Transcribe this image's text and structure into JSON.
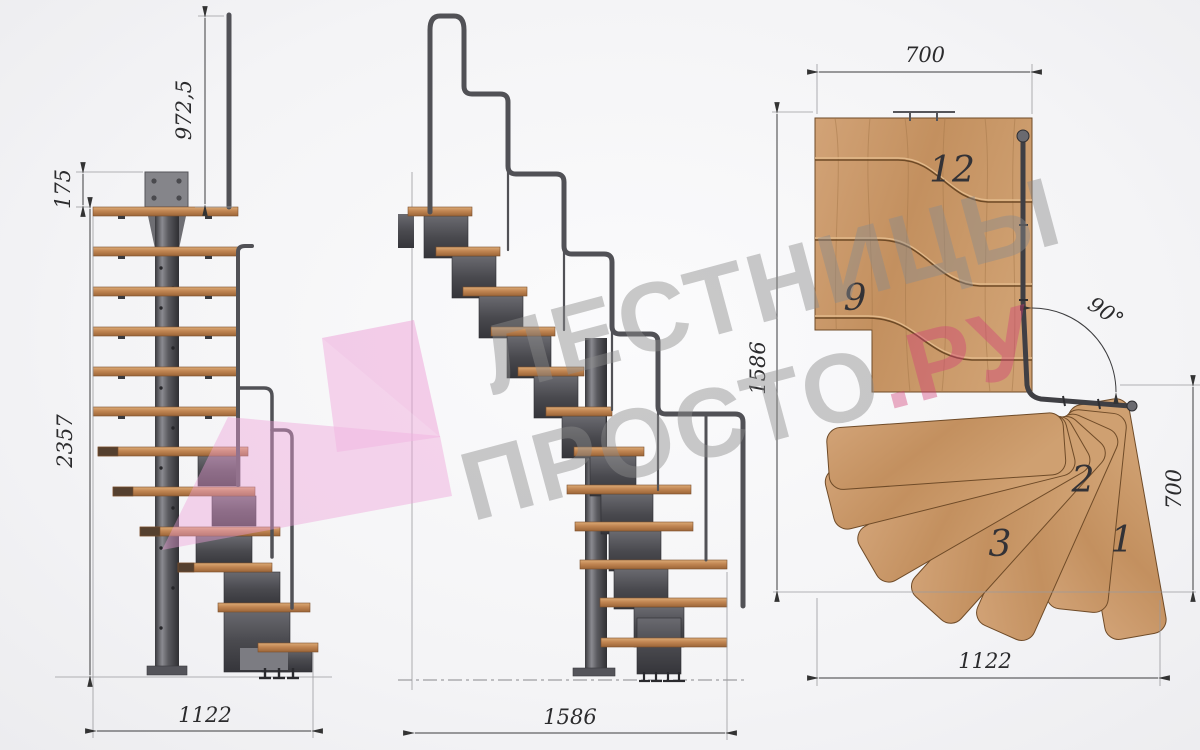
{
  "watermark": {
    "line1": "ЛЕСТНИЦЫ",
    "line2_gray": "ПРОСТО",
    "line2_accent": ".РУ",
    "gray_color": "#8c8c8c",
    "accent_color": "#d23f78",
    "arrow_color": "#ee9fd8"
  },
  "views": {
    "side": {
      "dim_rail_height": "972,5",
      "dim_plate": "175",
      "dim_total_height": "2357",
      "dim_width": "1122"
    },
    "front": {
      "dim_length": "1586"
    },
    "plan": {
      "dim_top": "700",
      "dim_left": "1586",
      "dim_angle": "90°",
      "dim_right": "700",
      "dim_bottom": "1122",
      "treads": [
        "12",
        "9",
        "2",
        "3",
        "1"
      ]
    }
  },
  "colors": {
    "metal_dark": "#47474b",
    "wood_side": "#bf8050",
    "wood_plan": "#c99b6e",
    "dim_line": "#3c3c3e"
  }
}
